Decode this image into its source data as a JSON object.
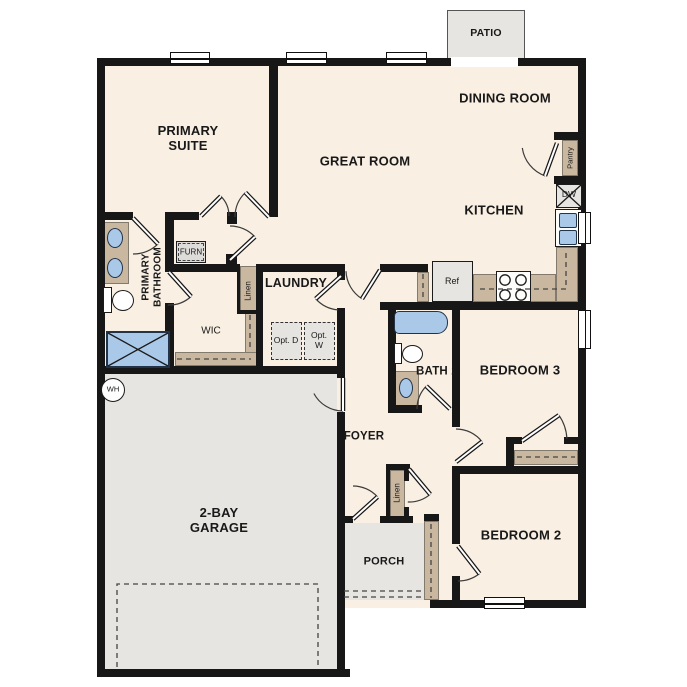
{
  "colors": {
    "floor": "#f9efe2",
    "concrete": "#e7e5e2",
    "cabinetry": "#c9b7a0",
    "fixture_blue": "#aac9e9",
    "wall": "#171717"
  },
  "rooms": {
    "patio": "PATIO",
    "dining_room": "DINING ROOM",
    "great_room": "GREAT ROOM",
    "primary_suite": "PRIMARY SUITE",
    "kitchen": "KITCHEN",
    "primary_bathroom": "PRIMARY BATHROOM",
    "wic": "WIC",
    "laundry": "LAUNDRY",
    "bath2": "BATH 2",
    "bedroom3": "BEDROOM 3",
    "bedroom2": "BEDROOM 2",
    "foyer": "FOYER",
    "porch": "PORCH",
    "garage": "2-BAY GARAGE"
  },
  "fixtures": {
    "furnace": "FURN",
    "refrigerator": "Ref",
    "dishwasher": "DW",
    "pantry": "Pantry",
    "linen_hall": "Linen",
    "linen_foyer": "Linen",
    "opt_dryer": "Opt. D",
    "opt_washer": "Opt. W",
    "water_heater": "WH"
  }
}
